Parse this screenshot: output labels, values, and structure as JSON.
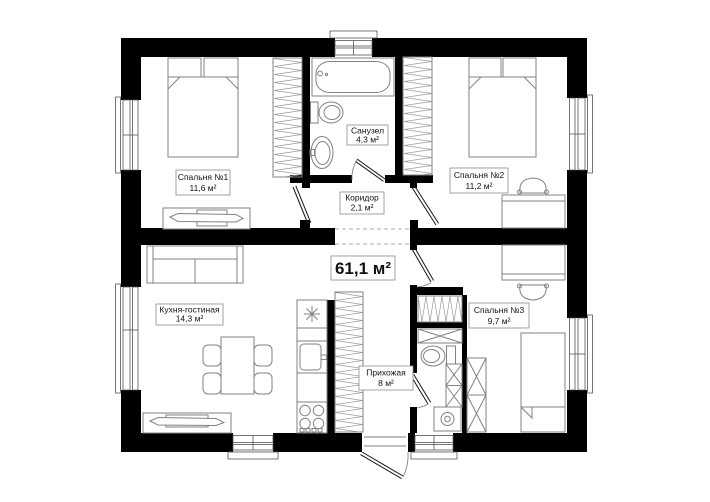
{
  "plan": {
    "total_area": "61,1 м²",
    "rooms": {
      "bedroom1": {
        "name": "Спальня №1",
        "area": "11,6 м²"
      },
      "bathroom": {
        "name": "Санузел",
        "area": "4,3 м²"
      },
      "bedroom2": {
        "name": "Спальня №2",
        "area": "11,2 м²"
      },
      "corridor": {
        "name": "Коридор",
        "area": "2,1 м²"
      },
      "kitchen_living": {
        "name": "Кухня-гостиная",
        "area": "14,3 м²"
      },
      "hallway": {
        "name": "Прихожая",
        "area": "8 м²"
      },
      "bedroom3": {
        "name": "Спальня №3",
        "area": "9,7 м²"
      }
    },
    "colors": {
      "wall": "#000000",
      "furniture": "#828282",
      "hatch": "#9a9a9a",
      "label_border": "#8c8c8c",
      "text": "#111111",
      "background": "#ffffff"
    }
  }
}
